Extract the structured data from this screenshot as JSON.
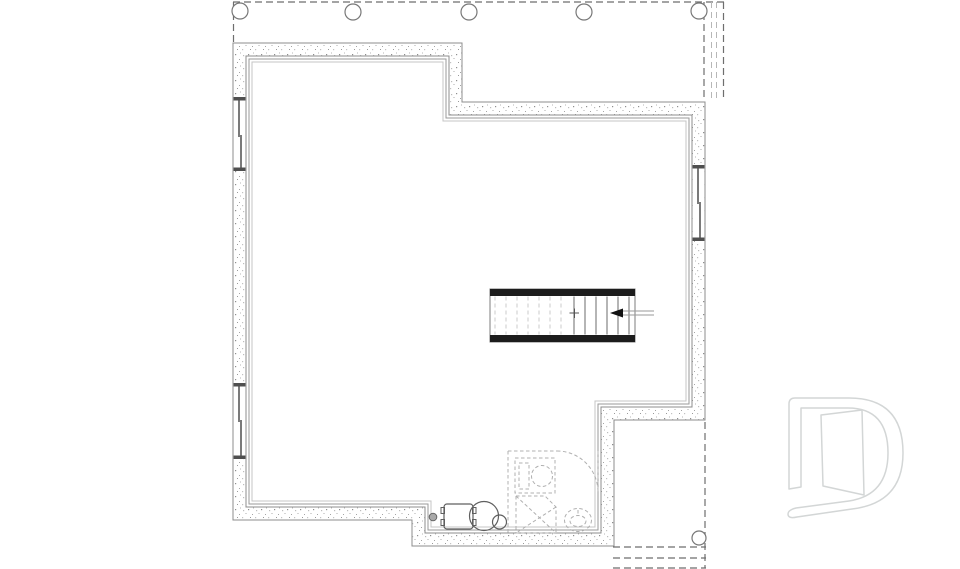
{
  "document": {
    "kind": "architectural floor plan drawing",
    "level": "basement / foundation plan",
    "visible_text": [],
    "notes": "line drawing only: concrete walls with stipple fill, dashed deck outline above, stair with up-arrow, future bathroom shown dashed, mechanical fixtures, light-gray builder logo watermark"
  },
  "colors": {
    "background": "#ffffff",
    "wall_line": "#8c8c8c",
    "stipple_dot": "#8f8f8f",
    "finish_line": "#9a9a9a",
    "stair_wall": "#1c1c1c",
    "tread_solid": "#6b6b6b",
    "tread_dashed": "#cbcbcb",
    "deck_dash": "#6e6e6e",
    "bath_dash": "#b0b0b0",
    "fixture_line": "#5f5f5f",
    "logo_line": "#d3d6d6"
  },
  "deck_top": {
    "posts": [
      [
        240,
        11
      ],
      [
        353,
        12
      ],
      [
        469,
        12
      ],
      [
        584,
        12
      ],
      [
        699,
        11
      ]
    ],
    "post_radius": 8
  },
  "deck_bottom": {
    "post": [
      699,
      538
    ],
    "post_radius": 7
  },
  "stairs": {
    "box": [
      490,
      289,
      145,
      53
    ],
    "treads_dashed_x": [
      495,
      506,
      517,
      528,
      539,
      550,
      561
    ],
    "treads_solid_x": [
      574,
      585,
      596,
      607,
      618,
      629
    ],
    "tread_top_y": 296.5,
    "tread_bottom_y": 334.5,
    "direction_arrow": "left"
  },
  "symbols": [
    "deck-outline-dashed",
    "deck-post",
    "concrete-wall",
    "window-slider",
    "staircase",
    "stair-direction-arrow",
    "floor-drain",
    "furnace",
    "water-heater",
    "pressure-tank",
    "future-bathroom-dashed",
    "vanity-sink",
    "shower",
    "toilet",
    "under-deck-dashed",
    "builder-logo"
  ]
}
